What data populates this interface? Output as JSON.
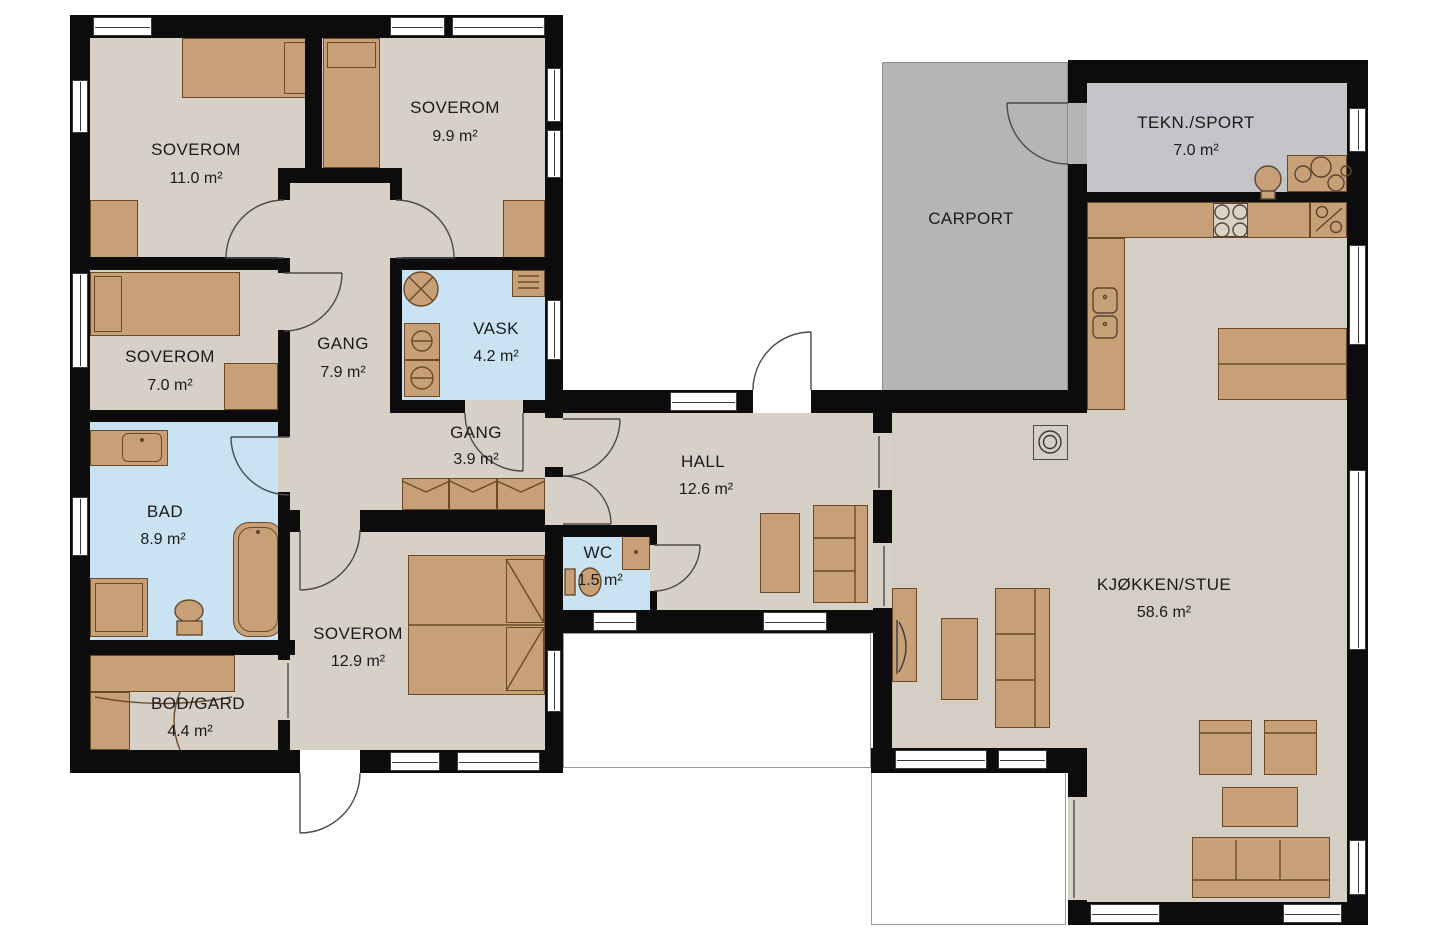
{
  "plan": {
    "title": "House floor plan",
    "rooms": [
      {
        "name": "SOVEROM",
        "area": "11.0 m²"
      },
      {
        "name": "SOVEROM",
        "area": "9.9 m²"
      },
      {
        "name": "SOVEROM",
        "area": "7.0 m²"
      },
      {
        "name": "GANG",
        "area": "7.9 m²"
      },
      {
        "name": "VASK",
        "area": "4.2 m²"
      },
      {
        "name": "GANG",
        "area": "3.9 m²"
      },
      {
        "name": "BAD",
        "area": "8.9 m²"
      },
      {
        "name": "BOD/GARD",
        "area": "4.4 m²"
      },
      {
        "name": "SOVEROM",
        "area": "12.9 m²"
      },
      {
        "name": "WC",
        "area": "1.5 m²"
      },
      {
        "name": "HALL",
        "area": "12.6 m²"
      },
      {
        "name": "CARPORT",
        "area": ""
      },
      {
        "name": "TEKN./SPORT",
        "area": "7.0 m²"
      },
      {
        "name": "KJØKKEN/STUE",
        "area": "58.6 m²"
      }
    ],
    "symbols": {
      "fridge_freezer": "percent-circles-icon"
    },
    "colors": {
      "wall": "#0c0c0c",
      "floor": "#d6d0c7",
      "wet_room": "#c9e3f3",
      "furniture": "#c8a078",
      "carport": "#b5b5b7",
      "technical_room": "#c5c5c9",
      "terrace": "#ffffff"
    }
  }
}
